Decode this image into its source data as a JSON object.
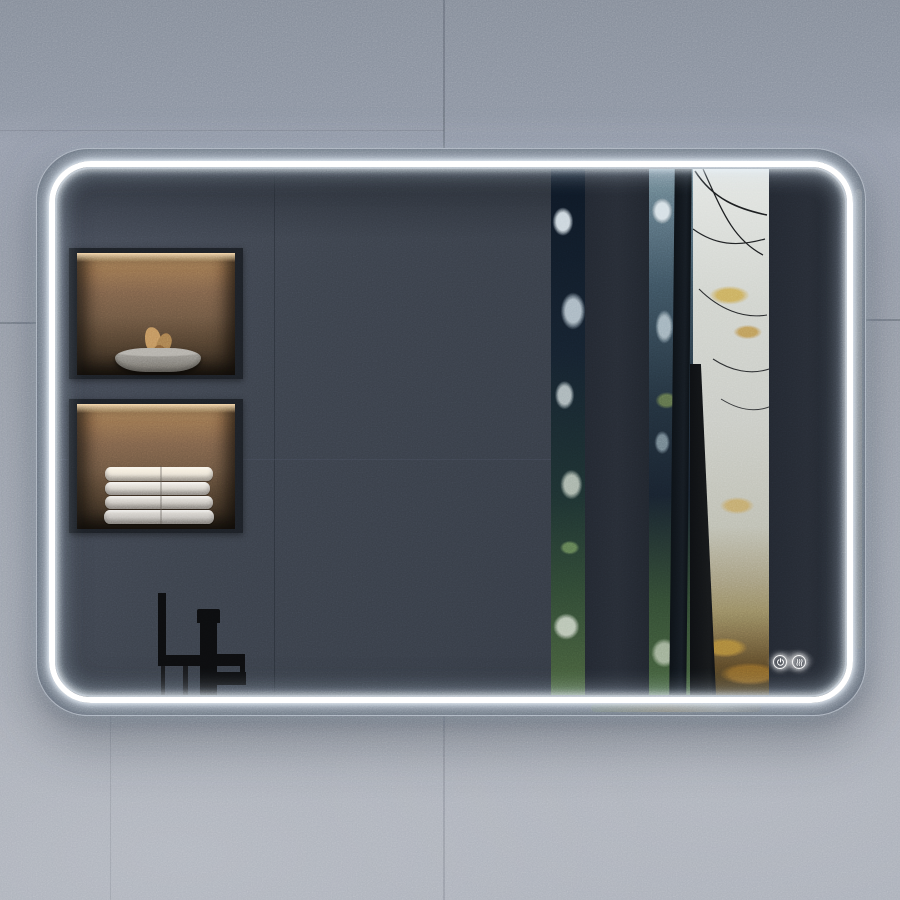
{
  "scene": {
    "type": "product-photo",
    "subject": "rectangular LED bathroom mirror with rounded corners",
    "setting": "grey concrete tiled wall",
    "mirror": {
      "lighting": "cool white perimeter LED strip",
      "touch_controls": [
        {
          "name": "power",
          "icon": "power-icon"
        },
        {
          "name": "demister",
          "icon": "demister-icon"
        }
      ]
    },
    "reflection": {
      "wall": "dark slate tiled bathroom wall",
      "niches": [
        {
          "position": "upper",
          "contents": "stone bowl with dried botanicals",
          "lighting": "warm recessed light"
        },
        {
          "position": "lower",
          "contents": "stack of four folded white towels",
          "lighting": "warm recessed light"
        }
      ],
      "fixture": "matte black freestanding bath tap",
      "window_view": "misty autumn forest with dark tree trunks and golden leaves seen between dark window mullions"
    }
  },
  "palette": {
    "wall-top": "#848c99",
    "wall-main": "#9ba1ac",
    "wall-bottom": "#a7acb6",
    "wall-seam": "#5f6570",
    "mirror-rim": "#4d535e",
    "led-white": "#ffffff",
    "reflection-bg": "#3b414b",
    "reflection-dark": "#2e333d",
    "slat": "#262b34",
    "niche-frame": "#1c2026",
    "niche-top": "#b08a5f",
    "niche-mid": "#6e5742",
    "niche-bottom": "#2e251c",
    "towel-lit": "#f0e9dc",
    "towel-shade": "#c9c6c2",
    "bowl-stone": "#8f8c86",
    "botanical": "#c2945e",
    "faucet-black": "#0c0d0f",
    "forest-navy": "#15212e",
    "forest-green": "#48603c",
    "fog-light": "#c9cbc5",
    "trunk-dark": "#16181a"
  }
}
